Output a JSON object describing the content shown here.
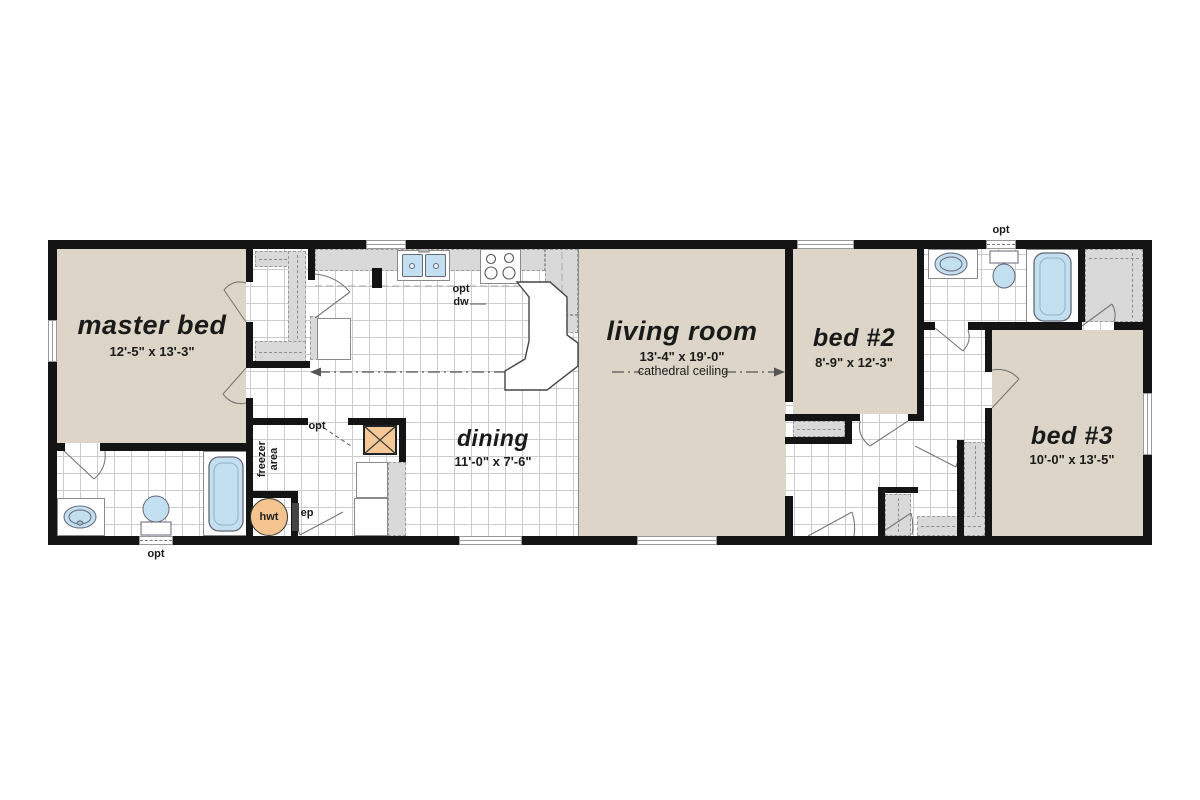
{
  "plan": {
    "title": "single-section home floor plan",
    "rooms": {
      "master_bed": {
        "name": "master bed",
        "dims": "12'-5\" x 13'-3\""
      },
      "dining": {
        "name": "dining",
        "dims": "11'-0\" x 7'-6\""
      },
      "living_room": {
        "name": "living room",
        "dims": "13'-4\" x 19'-0\"",
        "note": "cathedral ceiling"
      },
      "bed2": {
        "name": "bed #2",
        "dims": "8'-9\" x 12'-3\""
      },
      "bed3": {
        "name": "bed #3",
        "dims": "10'-0\" x 13'-5\""
      }
    },
    "labels": {
      "opt": "opt",
      "dw": "dw",
      "hwt": "hwt",
      "ep": "ep",
      "freezer_line1": "freezer",
      "freezer_line2": "area"
    },
    "colors": {
      "carpet": "#ddd6c8",
      "wall": "#141414",
      "counter_gray": "#d9d9d9",
      "fixture_blue": "#c3e0f1",
      "tank_orange": "#f3c48e"
    }
  }
}
